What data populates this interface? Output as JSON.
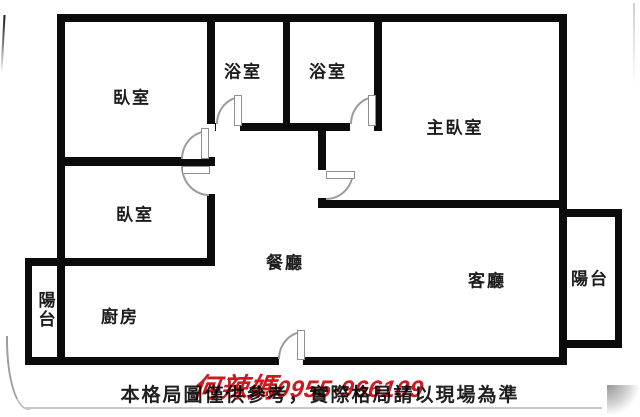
{
  "floorplan": {
    "wall_color": "#0b0b0b",
    "rooms": [
      {
        "id": "bedroom-1",
        "label": "臥室"
      },
      {
        "id": "bathroom-1",
        "label": "浴室"
      },
      {
        "id": "bathroom-2",
        "label": "浴室"
      },
      {
        "id": "master-bedroom",
        "label": "主臥室"
      },
      {
        "id": "bedroom-2",
        "label": "臥室"
      },
      {
        "id": "dining-room",
        "label": "餐廳"
      },
      {
        "id": "living-room",
        "label": "客廳"
      },
      {
        "id": "kitchen",
        "label": "廚房"
      },
      {
        "id": "balcony-left",
        "label": "陽台"
      },
      {
        "id": "balcony-right",
        "label": "陽台"
      }
    ]
  },
  "footer": {
    "disclaimer": "本格局圖僅供參考，實際格局請以現場為準"
  },
  "watermark": {
    "name": "何辣媽",
    "phone": "0955-966109",
    "color": "#cf1820"
  }
}
